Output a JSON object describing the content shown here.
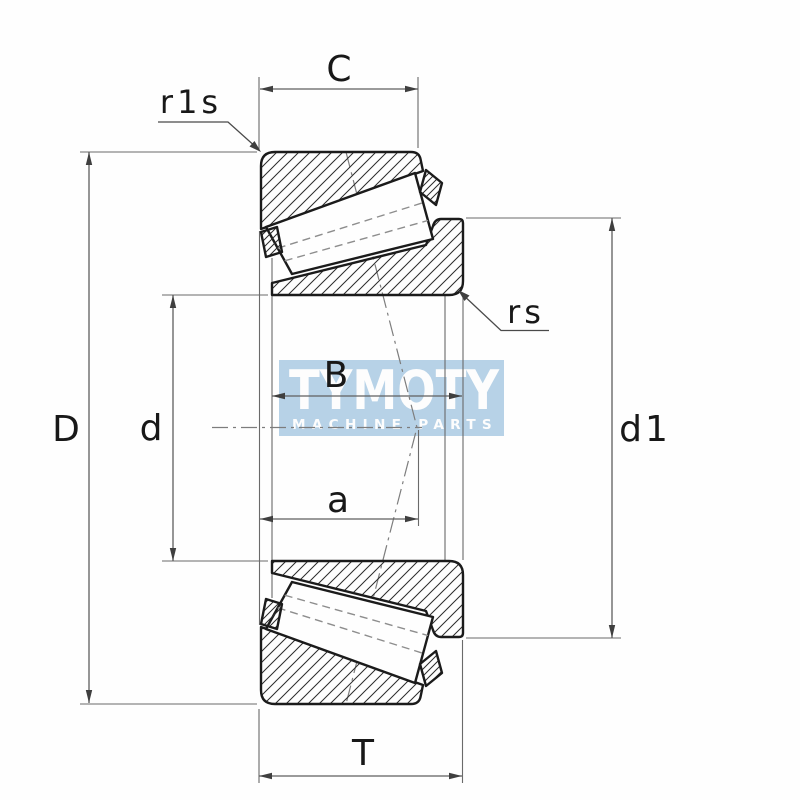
{
  "diagram": {
    "type": "tapered-roller-bearing-cross-section",
    "labels": {
      "cup_width": "C",
      "cup_corner_radius": "r1s",
      "outer_diameter": "D",
      "bore_diameter": "d",
      "cone_width": "B",
      "load_center_distance": "a",
      "cone_corner_radius": "rs",
      "rib_diameter": "d1",
      "total_width": "T"
    },
    "watermark": {
      "title": "TYMOTY",
      "subtitle": "MACHINE PARTS"
    },
    "colors": {
      "background": "#fefefe",
      "outline": "#1b1b1b",
      "dimension_line": "#5f5f5f",
      "watermark_bg": "#b7d2e7",
      "watermark_text": "#fdfdfd"
    }
  }
}
